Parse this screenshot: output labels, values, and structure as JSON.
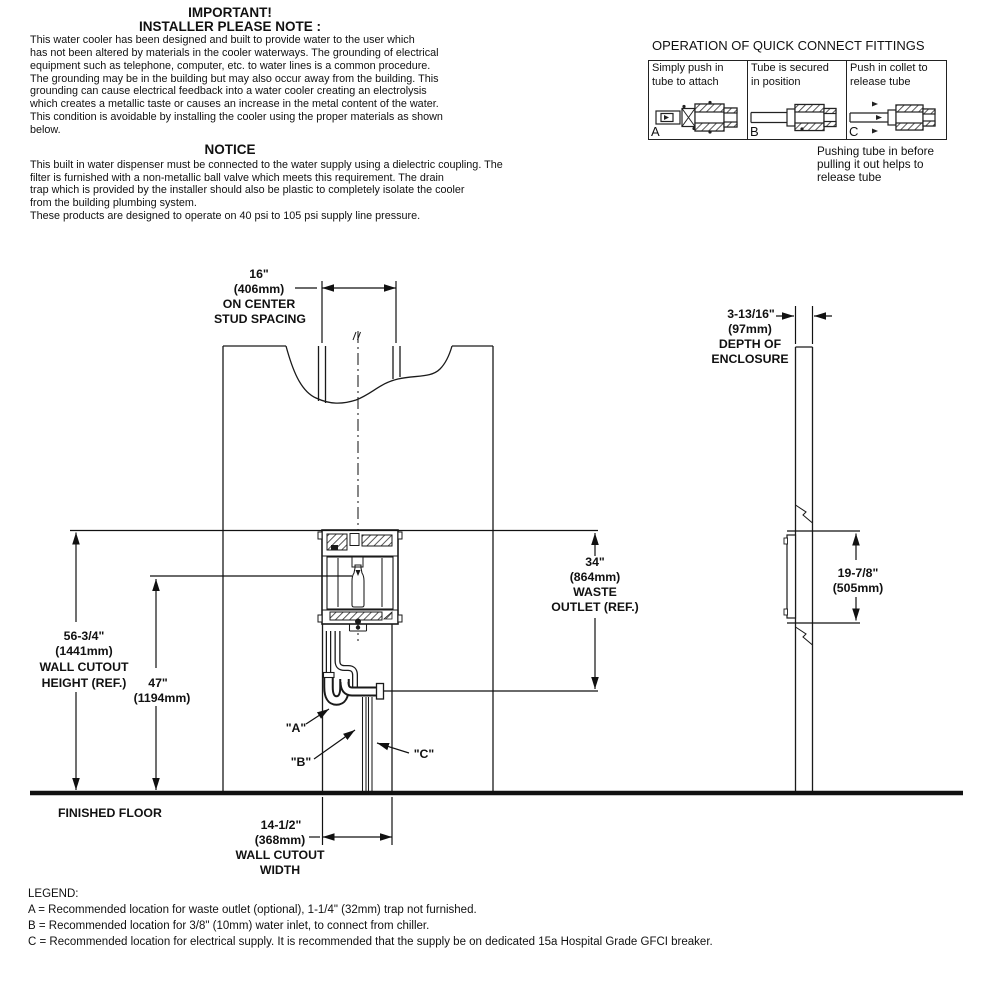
{
  "notes": {
    "important_title1": "IMPORTANT!",
    "important_title2": "INSTALLER PLEASE NOTE :",
    "important_lines": [
      "This water cooler has been designed and built to provide water to the user which",
      "has not been altered by materials in the cooler waterways. The grounding of electrical",
      "equipment such as telephone, computer, etc. to water lines is a common procedure.",
      "The grounding may be in the building but may also occur away from the building. This",
      "grounding can cause electrical feedback into a water cooler creating an electrolysis",
      "which creates a metallic taste or causes an increase in the metal content of the water.",
      "This condition is avoidable by installing the cooler using the proper materials as shown",
      "below."
    ],
    "notice_title": "NOTICE",
    "notice_lines": [
      "This built in water dispenser must be connected to the water supply using a dielectric coupling. The",
      "filter is furnished with a non-metallic ball valve which meets this requirement. The drain",
      "trap which is provided by the installer should also be plastic to completely isolate the cooler",
      "from the building plumbing system.",
      "These products are designed to operate on 40 psi  to 105 psi supply line pressure."
    ]
  },
  "fittings": {
    "title": "OPERATION OF QUICK CONNECT FITTINGS",
    "cells": [
      {
        "letter": "A",
        "line1": "Simply push in",
        "line2": "tube to attach"
      },
      {
        "letter": "B",
        "line1": "Tube is secured",
        "line2": "in position"
      },
      {
        "letter": "C",
        "line1": "Push in collet to",
        "line2": "release tube"
      }
    ],
    "caption_lines": [
      "Pushing tube in before",
      "pulling it out helps to",
      "release tube"
    ]
  },
  "diagram": {
    "stud_spacing": {
      "v": "16\"",
      "mm": "(406mm)",
      "l3": "ON CENTER",
      "l4": "STUD SPACING"
    },
    "depth": {
      "v": "3-13/16\"",
      "mm": "(97mm)",
      "l3": "DEPTH OF",
      "l4": "ENCLOSURE"
    },
    "waste": {
      "v": "34\"",
      "mm": "(864mm)",
      "l3": "WASTE",
      "l4": "OUTLET (REF.)"
    },
    "cutout_height": {
      "v": "56-3/4\"",
      "mm": "(1441mm)",
      "l3": "WALL CUTOUT",
      "l4": "HEIGHT (REF.)"
    },
    "trap_height": {
      "v": "47\"",
      "mm": "(1194mm)"
    },
    "side_height": {
      "v": "19-7/8\"",
      "mm": "(505mm)"
    },
    "cutout_width": {
      "v": "14-1/2\"",
      "mm": "(368mm)",
      "l3": "WALL CUTOUT",
      "l4": "WIDTH"
    },
    "finished_floor": "FINISHED FLOOR",
    "label_a": "\"A\"",
    "label_b": "\"B\"",
    "label_c": "\"C\""
  },
  "legend": {
    "title": "LEGEND:",
    "items": [
      "A = Recommended location for waste outlet (optional), 1-1/4\" (32mm) trap not furnished.",
      "B = Recommended location for 3/8\" (10mm) water inlet, to connect from chiller.",
      "C = Recommended location for electrical supply. It is recommended that the supply be on dedicated 15a Hospital Grade GFCI breaker."
    ]
  },
  "colors": {
    "ink": "#1a1a1a",
    "paper": "#ffffff"
  }
}
